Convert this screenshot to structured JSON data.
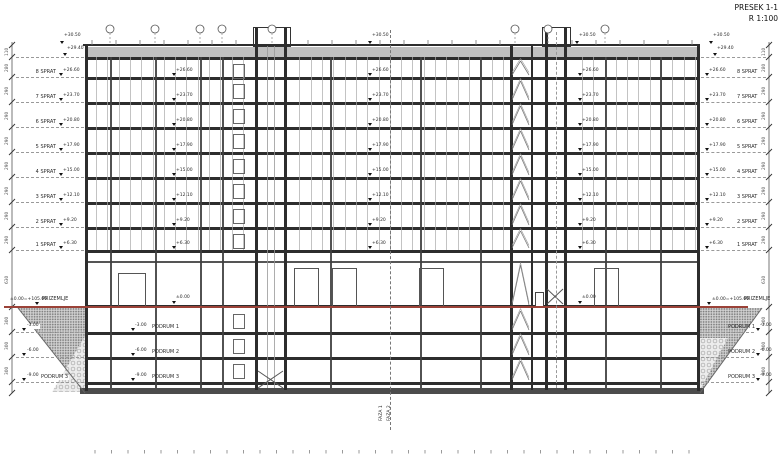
{
  "title": {
    "line1": "PRESEK 1-1",
    "line2": "R 1:100"
  },
  "top_levels": {
    "parapet": "+30.50",
    "roof_slab": "+29.40"
  },
  "floors": [
    {
      "label": "8 SPRAT",
      "elev": "+26.60"
    },
    {
      "label": "7 SPRAT",
      "elev": "+23.70"
    },
    {
      "label": "6 SPRAT",
      "elev": "+20.80"
    },
    {
      "label": "5 SPRAT",
      "elev": "+17.90"
    },
    {
      "label": "4 SPRAT",
      "elev": "+15.00"
    },
    {
      "label": "3 SPRAT",
      "elev": "+12.10"
    },
    {
      "label": "2 SPRAT",
      "elev": "+9.20"
    },
    {
      "label": "1 SPRAT",
      "elev": "+6.30"
    }
  ],
  "ground": {
    "label": "PRIZEMLJE",
    "elev_full": "±0.00=+105.00",
    "elev_short": "±0.00"
  },
  "basements": [
    {
      "label": "PODRUM 1",
      "elev": "-3.00"
    },
    {
      "label": "PODRUM 2",
      "elev": "-6.00"
    },
    {
      "label": "PODRUM 3",
      "elev": "-9.00"
    }
  ],
  "phase": {
    "line1": "FAZA 1",
    "line2": "FAZA 2"
  },
  "dimensions": {
    "parapet": "110",
    "attic": "280",
    "floor": "290",
    "ground_floor": "630",
    "basement": "300"
  },
  "colors": {
    "ground_line": "#9b4238",
    "structure": "#2d2d2d",
    "annotation": "#333333"
  }
}
